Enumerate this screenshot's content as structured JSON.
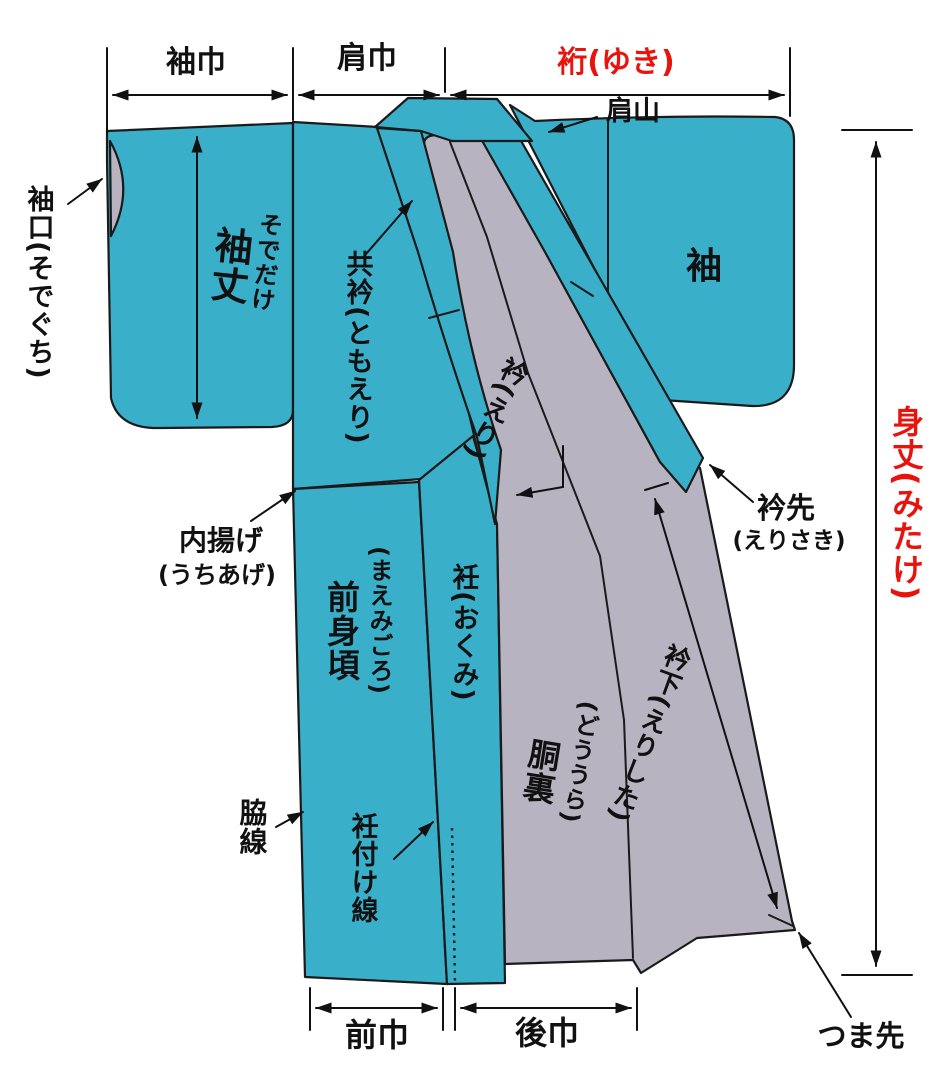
{
  "diagram": {
    "kind": "kimono-parts-measurement-diagram",
    "colors": {
      "fabric_teal": "#3AAFC9",
      "lining_gray": "#B8B3C1",
      "accent_red": "#E8130C",
      "line_black": "#1a1a1a",
      "background": "#ffffff"
    },
    "measurements": {
      "sode_haba": "袖巾",
      "kata_haba": "肩巾",
      "yuki": "裄(ゆき)",
      "mitake": "身丈(みたけ)",
      "sodetake_kanji": "袖丈",
      "sodetake_kana": "そでだけ",
      "erishita": "衿下(えりした)",
      "mae_haba": "前巾",
      "ushiro_haba": "後巾"
    },
    "parts": {
      "sodeguchi": "袖口(そでぐち)",
      "katayama": "肩山",
      "sode": "袖",
      "tomoeri": "共衿(ともえり)",
      "eri": "衿(えり)",
      "erisaki_kanji": "衿先",
      "erisaki_kana": "(えりさき)",
      "uchiage_kanji": "内揚げ",
      "uchiage_kana": "(うちあげ)",
      "maemigoro_kanji": "前身頃",
      "maemigoro_kana": "(まえみごろ)",
      "okumi": "衽(おくみ)",
      "douura_kanji": "胴裏",
      "douura_kana": "(どううら)",
      "wakisen": "脇線",
      "okumitsukesen": "衽付け線",
      "tsumasaki": "つま先"
    }
  }
}
